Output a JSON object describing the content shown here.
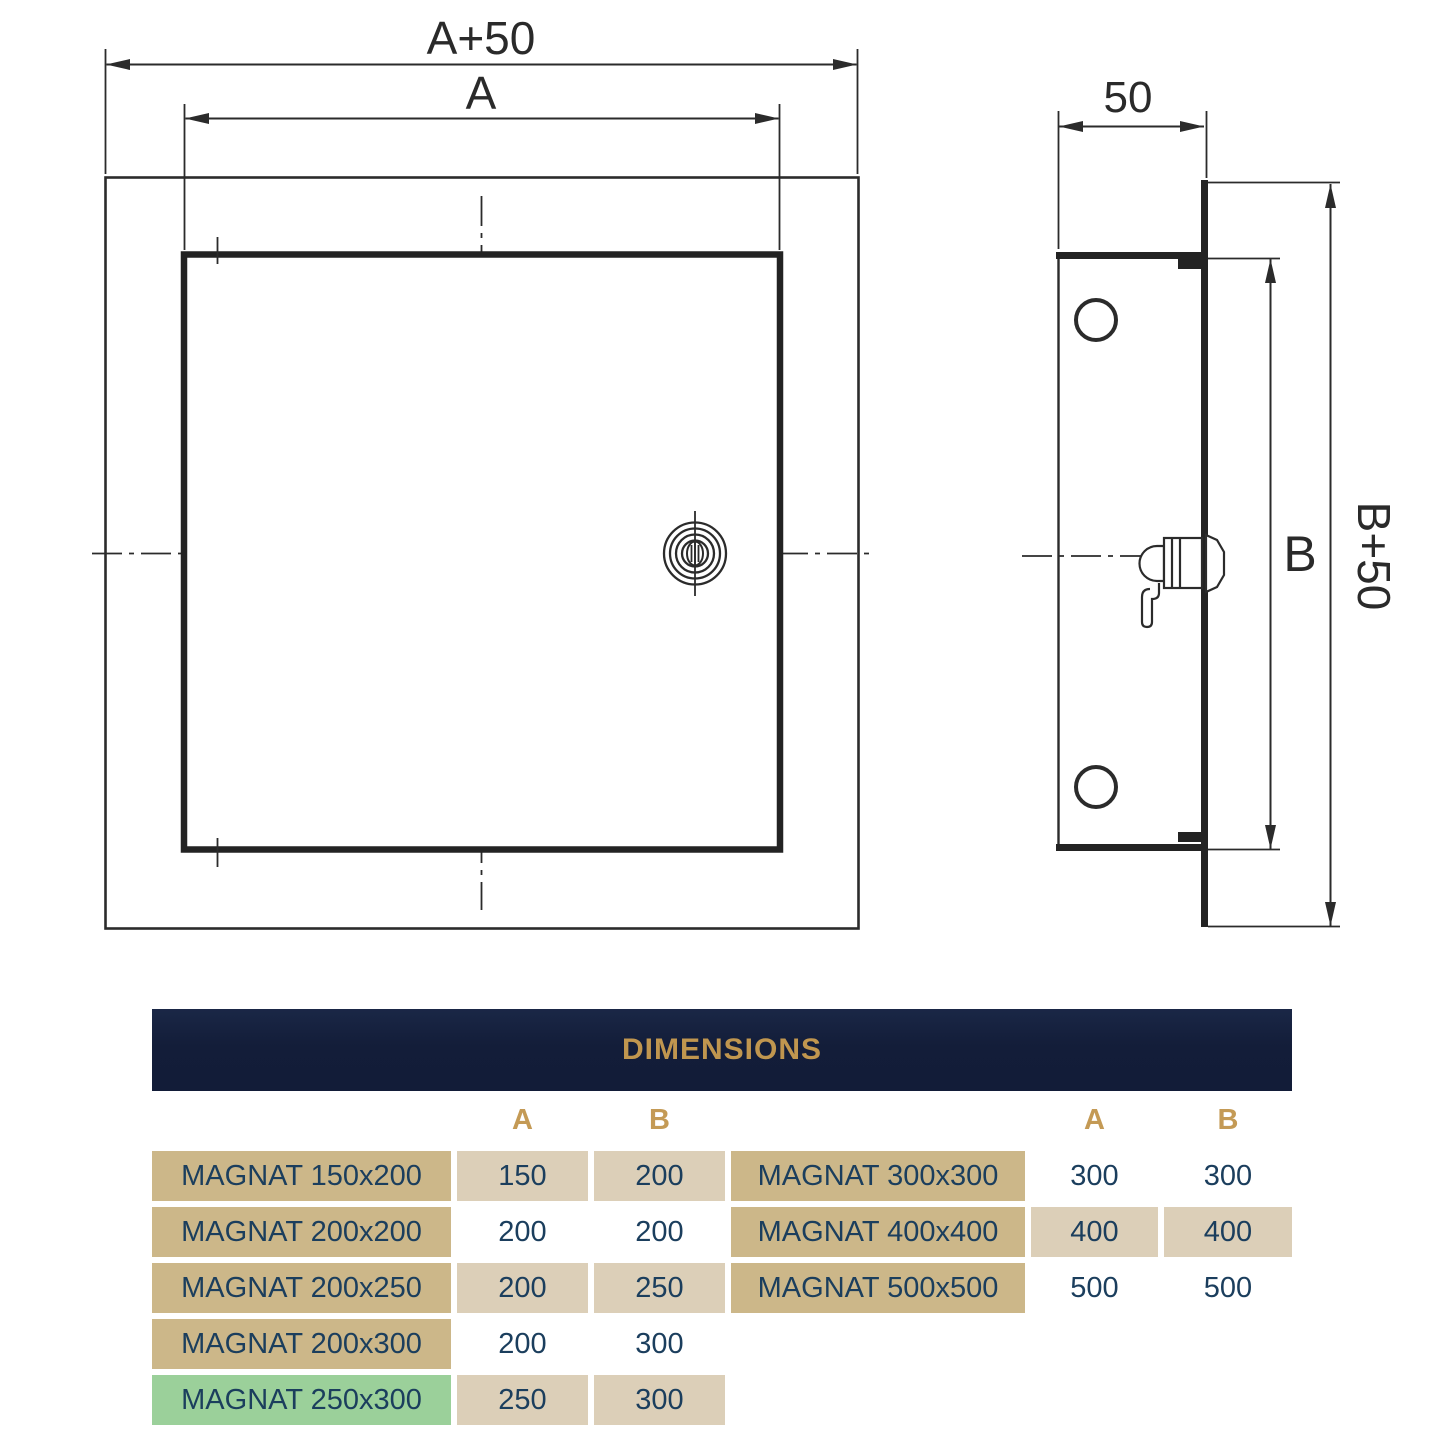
{
  "drawing": {
    "front_view": {
      "dim_outer_width_label": "A+50",
      "dim_inner_width_label": "A"
    },
    "side_view": {
      "dim_depth_label": "50",
      "dim_inner_height_label": "B",
      "dim_outer_height_label": "B+50"
    }
  },
  "table": {
    "title": "DIMENSIONS",
    "column_headers": {
      "a": "A",
      "b": "B"
    },
    "left_rows": [
      {
        "model": "MAGNAT 150x200",
        "a": "150",
        "b": "200",
        "highlight": false
      },
      {
        "model": "MAGNAT 200x200",
        "a": "200",
        "b": "200",
        "highlight": false
      },
      {
        "model": "MAGNAT 200x250",
        "a": "200",
        "b": "250",
        "highlight": false
      },
      {
        "model": "MAGNAT 200x300",
        "a": "200",
        "b": "300",
        "highlight": false
      },
      {
        "model": "MAGNAT 250x300",
        "a": "250",
        "b": "300",
        "highlight": true
      }
    ],
    "right_rows": [
      {
        "model": "MAGNAT 300x300",
        "a": "300",
        "b": "300",
        "highlight": false
      },
      {
        "model": "MAGNAT 400x400",
        "a": "400",
        "b": "400",
        "highlight": false
      },
      {
        "model": "MAGNAT 500x500",
        "a": "500",
        "b": "500",
        "highlight": false
      }
    ]
  },
  "colors": {
    "header_navy": "#121c38",
    "subheader_teal": "#114663",
    "accent_gold": "#c0964f",
    "model_cell_tan": "#ccb789",
    "value_cell_tan": "#dccfb8",
    "highlight_green": "#9bd09a",
    "table_text_navy": "#1b3e5d",
    "drawing_line": "#2b2b2b"
  }
}
